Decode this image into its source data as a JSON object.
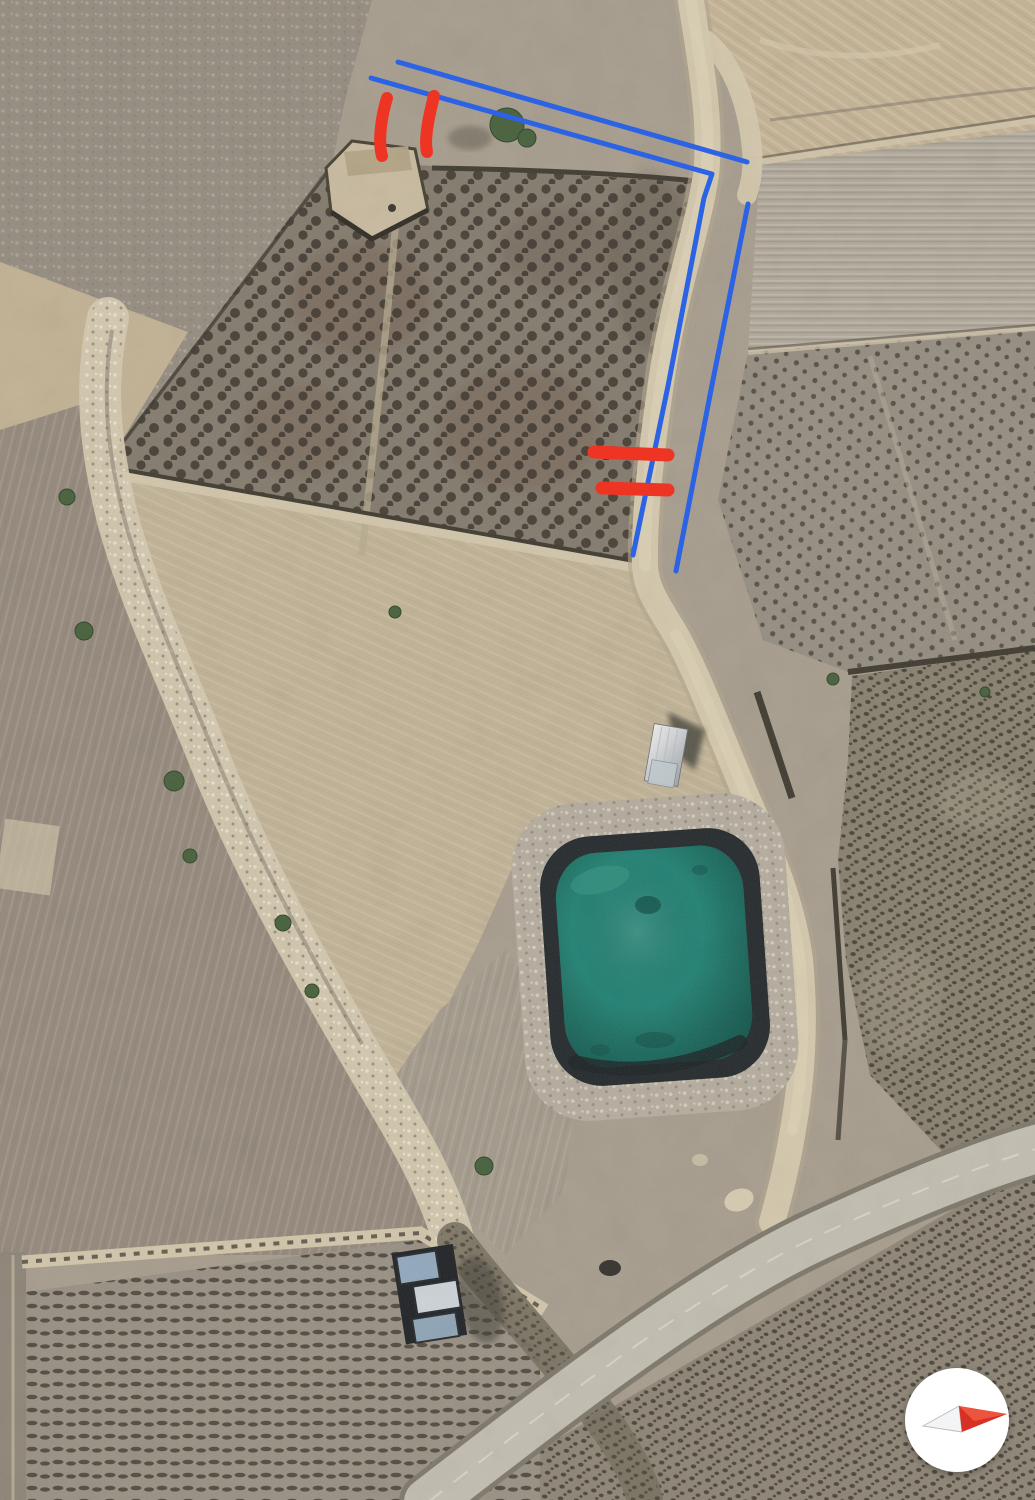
{
  "view": {
    "width": 1035,
    "height": 1500
  },
  "colors": {
    "annotation_blue": "#2b63e4",
    "annotation_red": "#ee3524",
    "pond_water": "#1f8273",
    "pond_liner": "#23282b",
    "track": "#d6caae",
    "paved_road": "#c4bfb2",
    "compass_bg": "#ffffff",
    "compass_red": "#d93025",
    "compass_grey": "#f2f4f5"
  },
  "annotations": {
    "blue_lines": [
      {
        "id": "upper-outer-line",
        "points": "398,62 747,162"
      },
      {
        "id": "upper-inner-line-with-corner",
        "points": "371,78 712,174 704,198 668,386 633,555"
      },
      {
        "id": "right-outer-line",
        "points": "748,204 711,390 676,571"
      }
    ],
    "red_marks": [
      {
        "id": "tick-1",
        "path": "M 387,98 C 381,118 378,141 382,156"
      },
      {
        "id": "tick-2",
        "path": "M 434,96 C 429,116 424,138 427,152"
      },
      {
        "id": "bar-1",
        "path": "M 594,452 L 668,455"
      },
      {
        "id": "bar-2",
        "path": "M 602,488 L 668,490"
      }
    ]
  },
  "compass": {
    "icon": "compass-needle-icon"
  }
}
